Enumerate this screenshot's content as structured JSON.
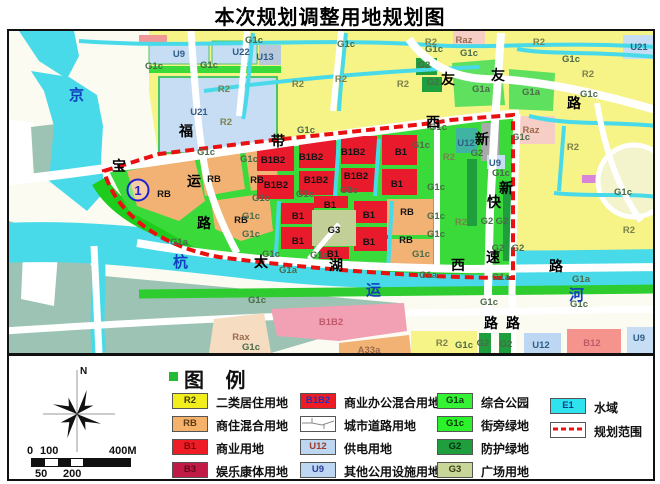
{
  "title": "本次规划调整用地规划图",
  "map": {
    "codes": {
      "R2": "R2",
      "RB": "RB",
      "B1": "B1",
      "B3": "B3",
      "B1B2": "B1B2",
      "G1a": "G1a",
      "G1c": "G1c",
      "G2": "G2",
      "G3": "G3",
      "U9": "U9",
      "U12": "U12",
      "U13": "U13",
      "U21": "U21",
      "U22": "U22",
      "Raz": "Raz",
      "Rax": "Rax",
      "A33a": "A33a",
      "B12": "B12"
    },
    "water_name_chars": [
      "京",
      "杭",
      "运",
      "河"
    ],
    "roads": {
      "fuyunlu": [
        "福",
        "运",
        "路"
      ],
      "baodaixilu": [
        "宝",
        "带",
        "西"
      ],
      "youyoulu": [
        "友",
        "友",
        "路"
      ],
      "taihuxilu": [
        "太",
        "湖",
        "西",
        "路"
      ],
      "xinkuaisulu": [
        "新",
        "快",
        "速",
        "路"
      ],
      "xinlu": [
        "新",
        "路"
      ]
    },
    "marker_1": "①",
    "marker_1_digit": "1"
  },
  "legend": {
    "title": "图 例",
    "items": [
      {
        "code": "R2",
        "label": "二类居住用地"
      },
      {
        "code": "RB",
        "label": "商住混合用地"
      },
      {
        "code": "B1",
        "label": "商业用地"
      },
      {
        "code": "B3",
        "label": "娱乐康体用地"
      },
      {
        "code": "B1B2",
        "label": "商业办公混合用地"
      },
      {
        "code": "",
        "label": "城市道路用地"
      },
      {
        "code": "U12",
        "label": "供电用地"
      },
      {
        "code": "U9",
        "label": "其他公用设施用地"
      },
      {
        "code": "G1a",
        "label": "综合公园"
      },
      {
        "code": "G1c",
        "label": "街旁绿地"
      },
      {
        "code": "G2",
        "label": "防护绿地"
      },
      {
        "code": "G3",
        "label": "广场用地"
      },
      {
        "code": "E1",
        "label": "水域"
      },
      {
        "code": "",
        "label": "规划范围"
      }
    ]
  },
  "compass": {
    "north_label": "N"
  },
  "scale_bar": {
    "labels_top": [
      "0",
      "100",
      "400M"
    ],
    "labels_bottom": [
      "50",
      "200"
    ]
  },
  "colors": {
    "water": "#48dae9",
    "residential_R2": "#f6f387",
    "mixed_RB": "#f2b273",
    "commercial_B1": "#e81a2c",
    "park_G1a": "#1ecc1e",
    "green_G1c": "#3ada3a",
    "protective_G2": "#1e9e3c",
    "plaza_G3": "#c2cf96",
    "utility_U": "#c6ddf4",
    "boundary_red": "#e81010",
    "out_of_scope_sage": "#9cc3b4"
  }
}
